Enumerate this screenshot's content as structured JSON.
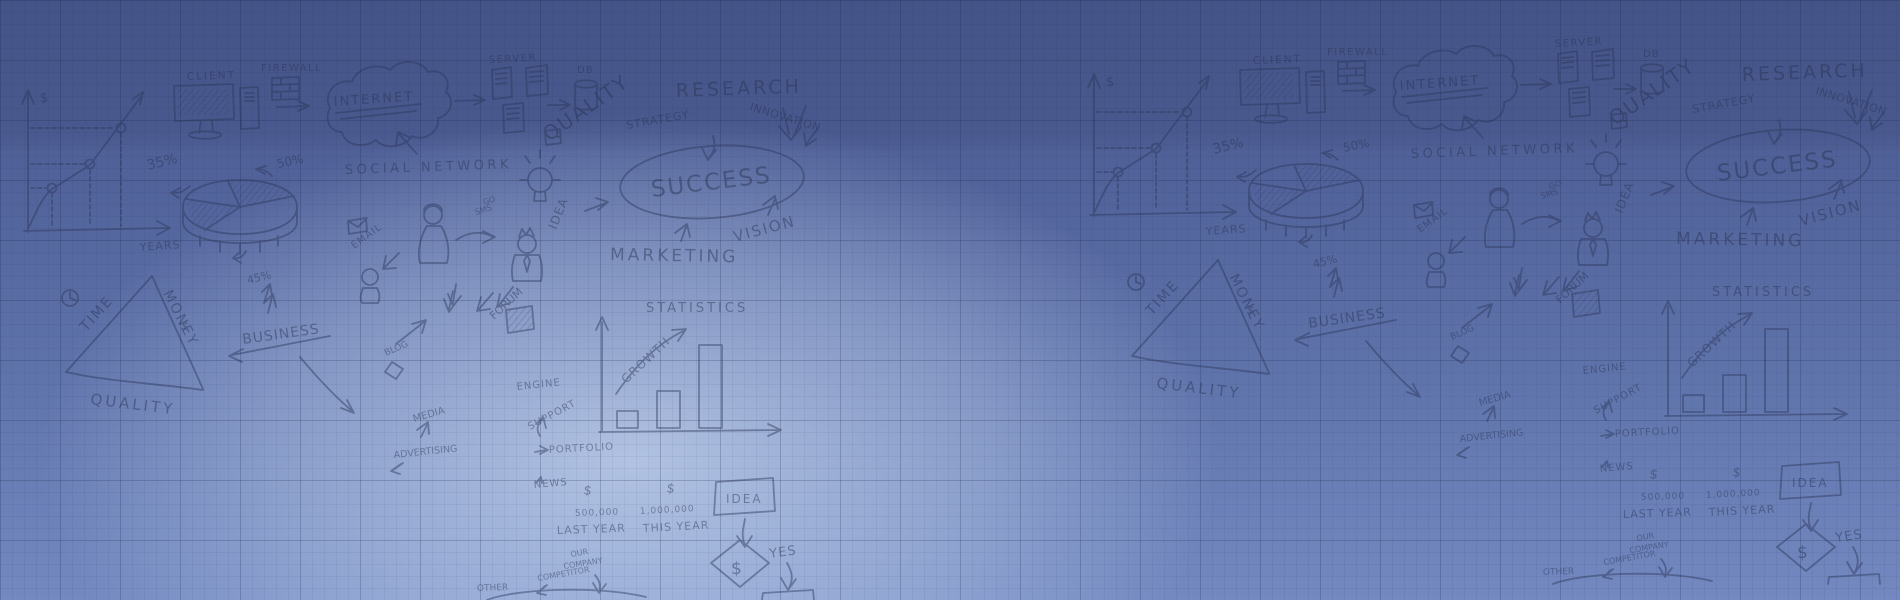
{
  "palette": {
    "bg_top": "#49598f",
    "bg_bottom": "#7389c0",
    "center_glow": "#9fbdf0",
    "grid_line": "#182142",
    "sketch_ink": "#2b365a"
  },
  "doodle": {
    "dollar": "$",
    "years": "YEARS",
    "pct35": "35%",
    "pct50": "50%",
    "pct45": "45%",
    "client": "CLIENT",
    "firewall": "FIREWALL",
    "internet": "INTERNET",
    "server": "SERVER",
    "db": "DB",
    "quality": "QUALITY",
    "strategy": "STRATEGY",
    "research": "RESEARCH",
    "innovation": "INNOVATION",
    "social_network": "SOCIAL NETWORK",
    "email": "EMAIL",
    "go": "GO",
    "sms": "SMS",
    "idea": "IDEA",
    "success": "SUCCESS",
    "vision": "VISION",
    "marketing": "MARKETING",
    "time": "TIME",
    "money": "MONEY",
    "business": "BUSINESS",
    "blog": "BLOG",
    "forum": "FORUM",
    "statistics": "STATISTICS",
    "growth": "GROWTH",
    "engine": "ENGINE",
    "support": "SUPPORT",
    "portfolio": "PORTFOLIO",
    "news": "NEWS",
    "n500k": "500,000",
    "n1m": "1,000,000",
    "last_year": "LAST YEAR",
    "this_year": "THIS YEAR",
    "media": "MEDIA",
    "advertising": "ADVERTISING",
    "yes": "YES",
    "our": "OUR",
    "company": "COMPANY",
    "competitor": "COMPETITOR",
    "other": "OTHER"
  }
}
